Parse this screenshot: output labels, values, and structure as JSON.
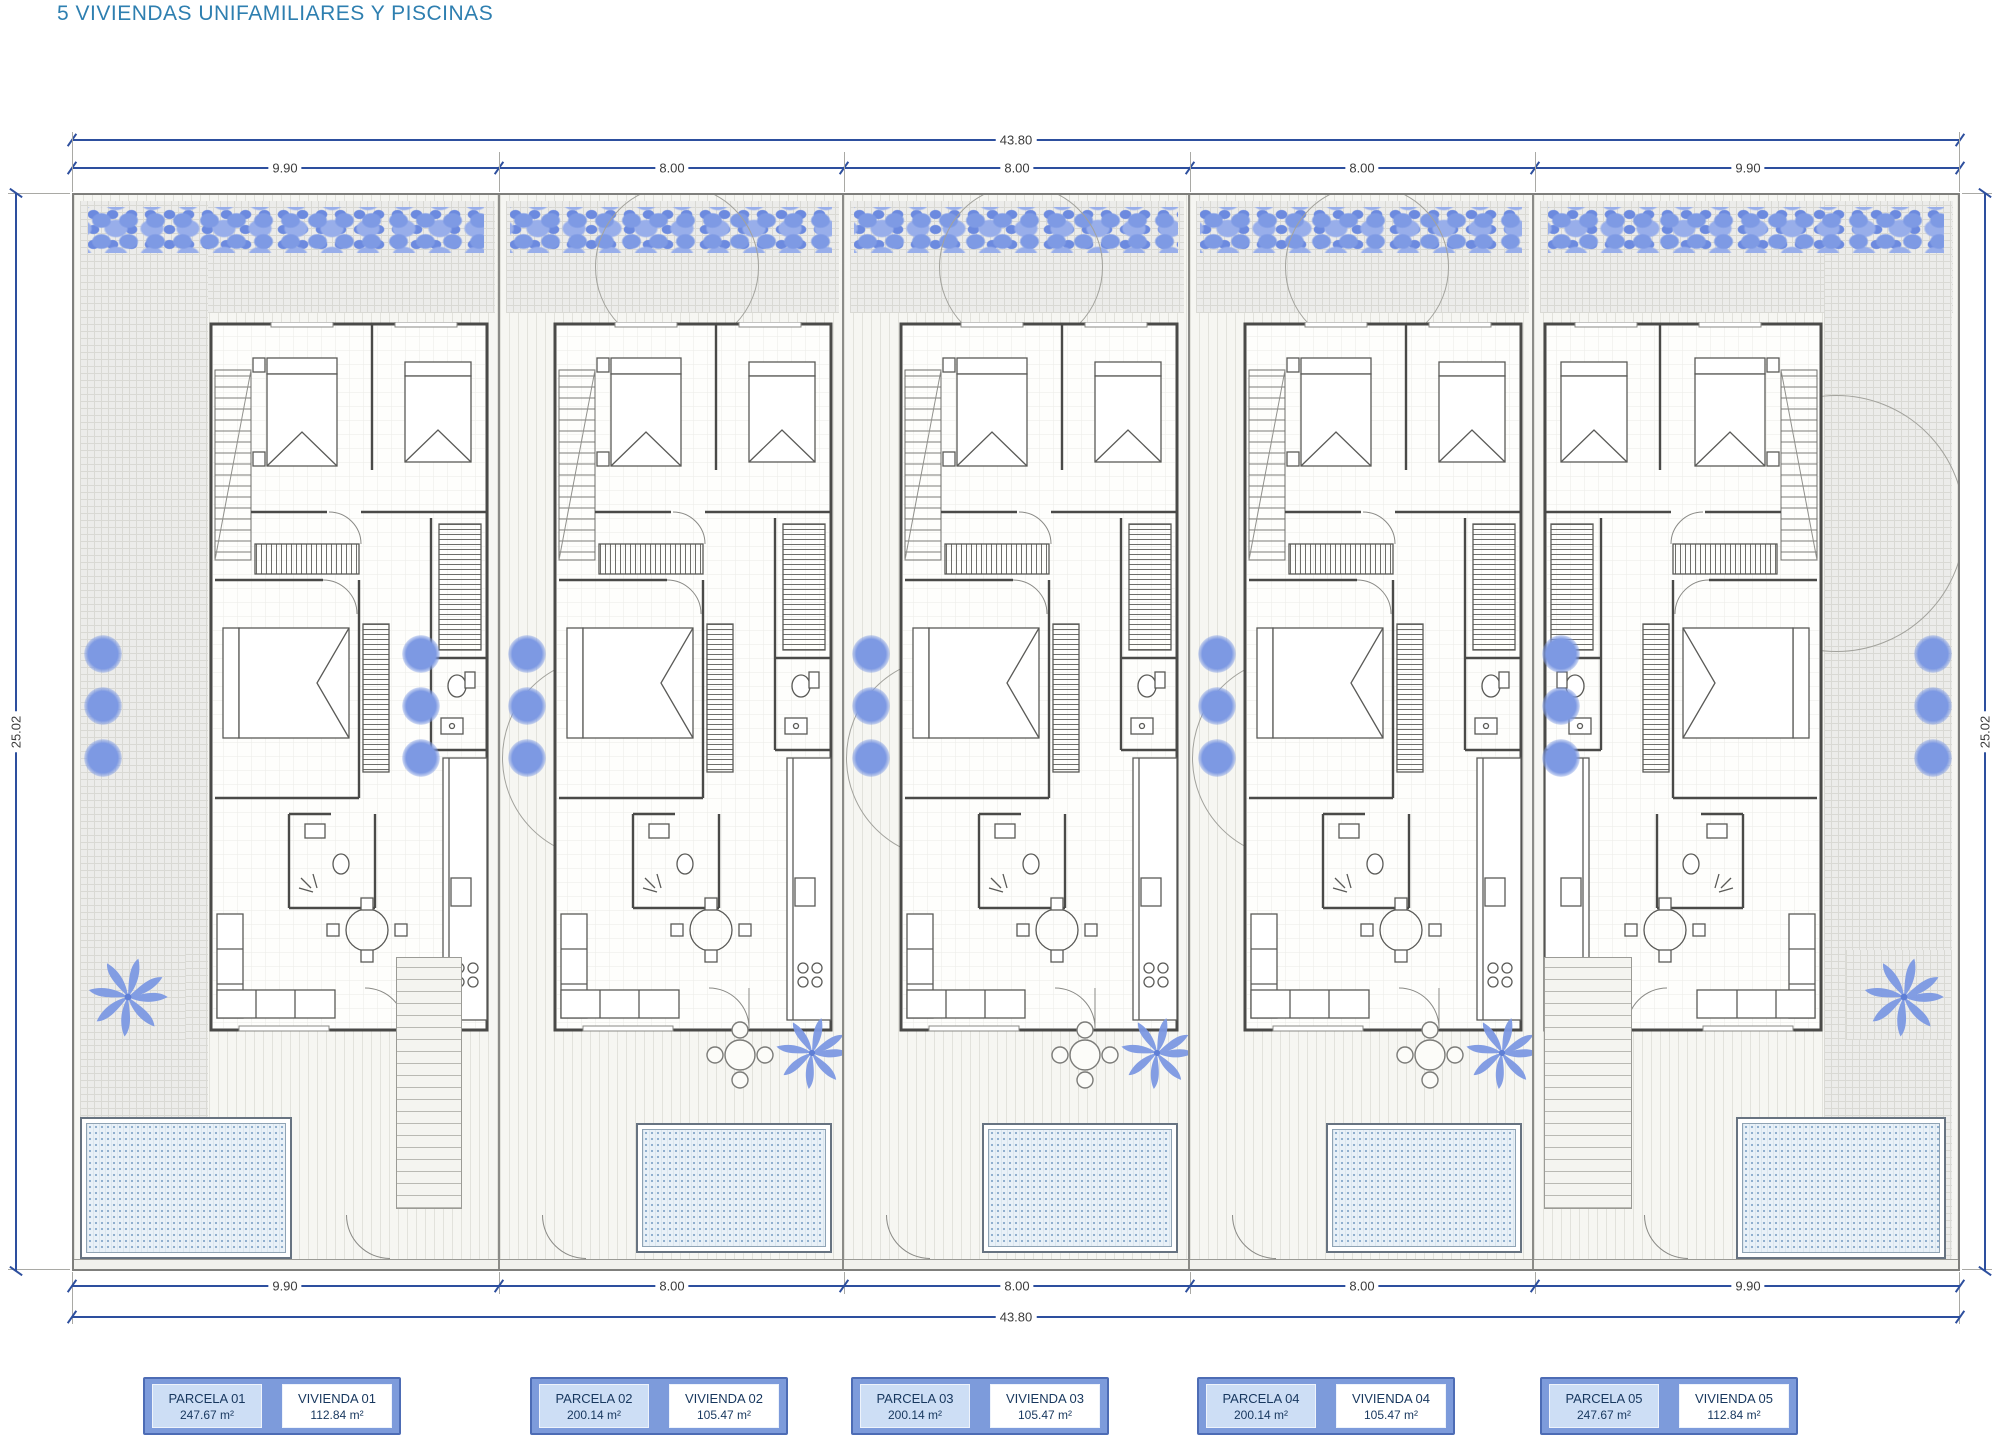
{
  "title": "5 VIVIENDAS UNIFAMILIARES Y PISCINAS",
  "dimensions": {
    "top": {
      "overall": "43.80",
      "segments": [
        "9.90",
        "8.00",
        "8.00",
        "8.00",
        "9.90"
      ]
    },
    "bottom": {
      "segments": [
        "9.90",
        "8.00",
        "8.00",
        "8.00",
        "9.90"
      ],
      "overall": "43.80"
    },
    "left": "25.02",
    "right": "25.02"
  },
  "plan": {
    "units": 5,
    "plot_width_m": 43.8,
    "plot_depth_m": 25.02,
    "parcel_widths_m": [
      9.9,
      8.0,
      8.0,
      8.0,
      9.9
    ]
  },
  "legend": {
    "pairs": [
      {
        "parcela_label": "PARCELA 01",
        "parcela_area": "247.67 m²",
        "vivienda_label": "VIVIENDA 01",
        "vivienda_area": "112.84 m²"
      },
      {
        "parcela_label": "PARCELA 02",
        "parcela_area": "200.14 m²",
        "vivienda_label": "VIVIENDA 02",
        "vivienda_area": "105.47 m²"
      },
      {
        "parcela_label": "PARCELA 03",
        "parcela_area": "200.14 m²",
        "vivienda_label": "VIVIENDA 03",
        "vivienda_area": "105.47 m²"
      },
      {
        "parcela_label": "PARCELA 04",
        "parcela_area": "200.14 m²",
        "vivienda_label": "VIVIENDA 04",
        "vivienda_area": "105.47 m²"
      },
      {
        "parcela_label": "PARCELA 05",
        "parcela_area": "247.67 m²",
        "vivienda_label": "VIVIENDA 05",
        "vivienda_area": "112.84 m²"
      }
    ]
  },
  "colors": {
    "title_text": "#2e7fb0",
    "dimension_line": "#2d4f9e",
    "dimension_text": "#3c3c3c",
    "plants_blue": "#7d99e3",
    "pool_water": "#e9f1f8",
    "legend_frame": "#7d9bdb",
    "legend_parcela_fill": "#cddef5",
    "legend_vivienda_fill": "#ffffff",
    "legend_text": "#17375e"
  }
}
